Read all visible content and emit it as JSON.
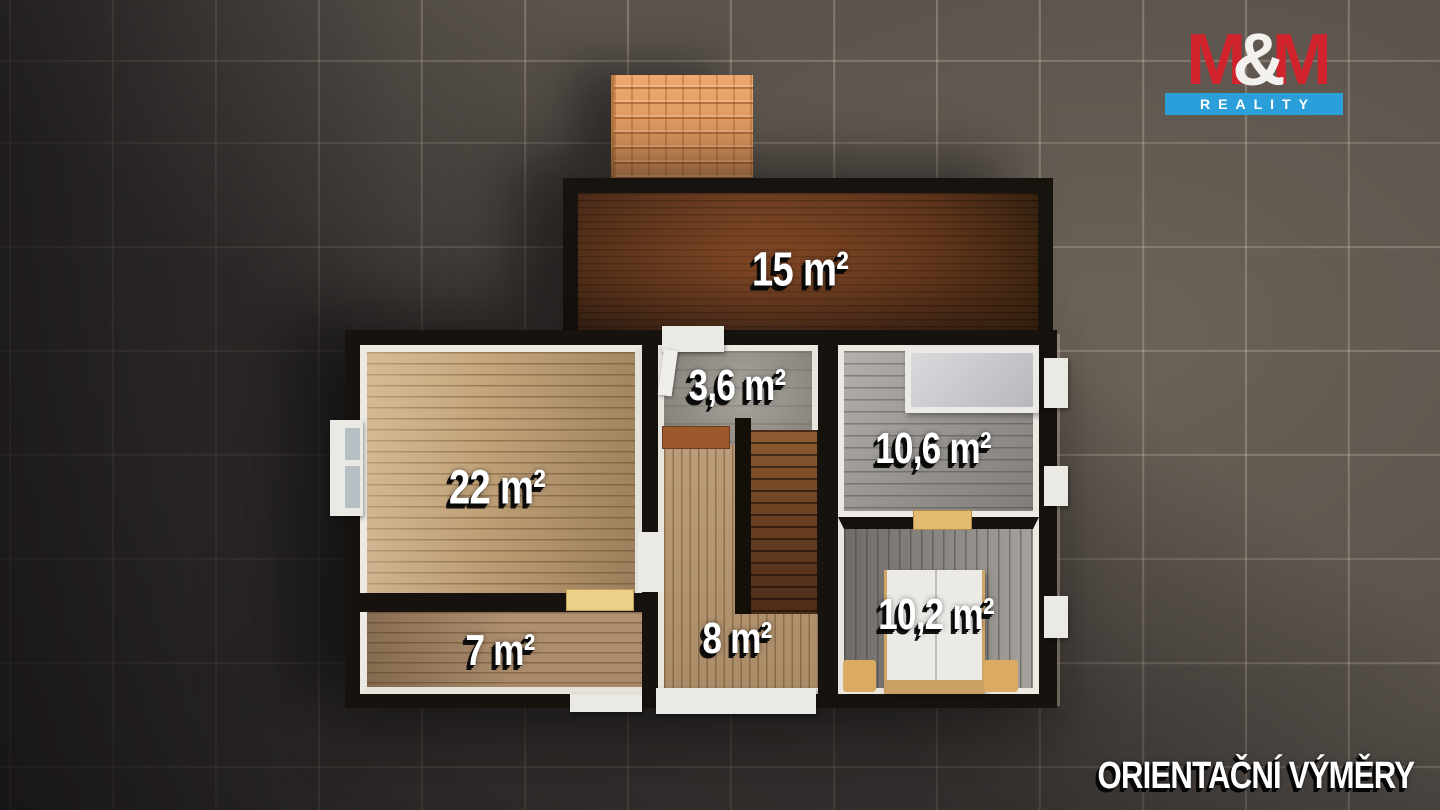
{
  "branding": {
    "logo_m1": "M",
    "logo_amp": "&",
    "logo_m2": "M",
    "logo_word": "REALITY",
    "brand_red": "#d0232b",
    "brand_blue": "#2b9fd9"
  },
  "footer": {
    "disclaimer": "ORIENTAČNÍ VÝMĚRY"
  },
  "floor_plan": {
    "rooms": [
      {
        "id": "terrace",
        "area_label": "15 m²"
      },
      {
        "id": "living-room",
        "area_label": "22 m²"
      },
      {
        "id": "bathroom",
        "area_label": "3,6 m²"
      },
      {
        "id": "bedroom-top-right",
        "area_label": "10,6 m²"
      },
      {
        "id": "room-bottom-left",
        "area_label": "7 m²"
      },
      {
        "id": "hallway-stairs",
        "area_label": "8 m²"
      },
      {
        "id": "bedroom-bottom-right",
        "area_label": "10,2 m²"
      }
    ]
  }
}
